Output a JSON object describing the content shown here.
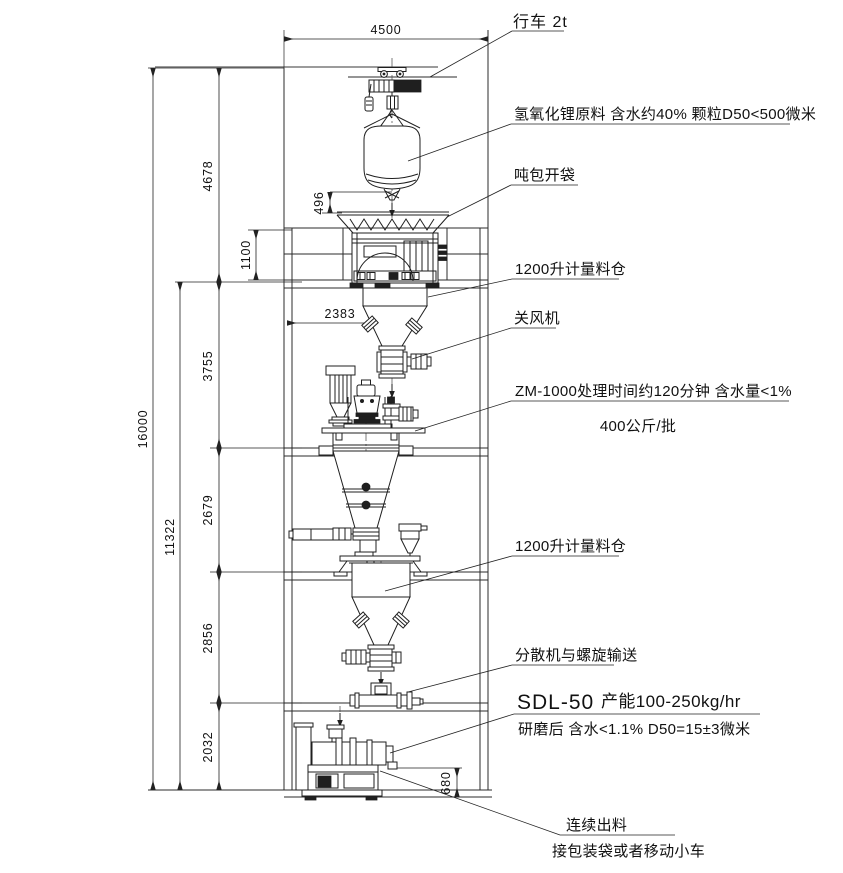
{
  "annotations": {
    "crane": "行车 2t",
    "raw_material": "氢氧化锂原料 含水约40% 颗粒D50<500微米",
    "bag_opening": "吨包开袋",
    "metering_silo_1": "1200升计量料仓",
    "rotary_valve": "关风机",
    "zm1000": "ZM-1000处理时间约120分钟 含水量<1%",
    "batch": "400公斤/批",
    "metering_silo_2": "1200升计量料仓",
    "disperser": "分散机与螺旋输送",
    "sdl50_model": "SDL-50",
    "sdl50_capacity": "产能100-250kg/hr",
    "after_grinding": "研磨后 含水<1.1% D50=15±3微米",
    "continuous_discharge": "连续出料",
    "receiving": "接包装袋或者移动小车"
  },
  "dimensions": {
    "total_height": "16000",
    "upper_section": "4678",
    "platform": "1100",
    "section_a": "3755",
    "section_b": "2679",
    "lower_total": "11322",
    "section_c": "2856",
    "section_d": "2032",
    "crane_span": "4500",
    "silo_offset": "2383",
    "bag_clearance": "496",
    "discharge_height": "680"
  }
}
